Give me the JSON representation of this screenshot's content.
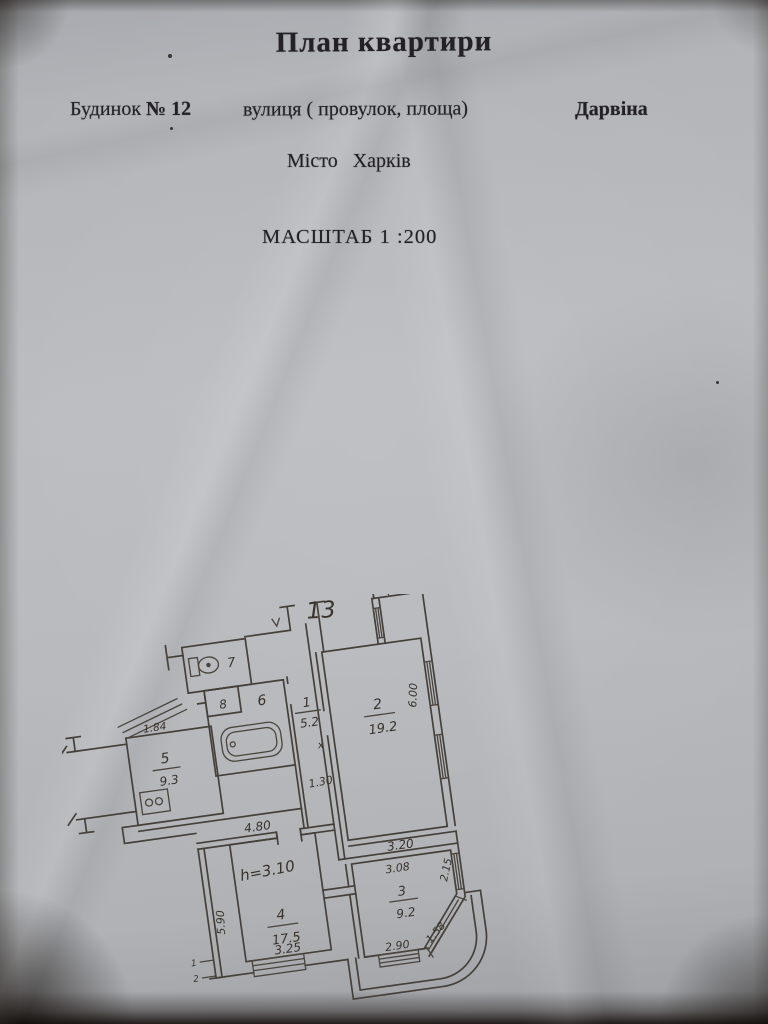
{
  "document": {
    "title": "План квартири",
    "building_label": "Будинок",
    "building_number": "№ 12",
    "street_label": "вулиця ( провулок, площа)",
    "street_name": "Дарвіна",
    "city": "Місто Харків",
    "scale": "МАСШТАБ 1 :200"
  },
  "plan": {
    "apartment_number": "13",
    "height_note": "h=3.10",
    "rooms": {
      "room1": {
        "num": "1",
        "area": "5.2"
      },
      "room2": {
        "num": "2",
        "area": "19.2"
      },
      "room3": {
        "num": "3",
        "area": "9.2"
      },
      "room4": {
        "num": "4",
        "area": "17.5"
      },
      "room5": {
        "num": "5",
        "area": "9.3"
      },
      "room6": {
        "num": "6"
      },
      "room7": {
        "num": "7"
      },
      "room8": {
        "num": "8"
      }
    },
    "dimensions": {
      "kitchen_top": "1.84",
      "kitchen_bottom": "4.80",
      "hall_width": "1.30",
      "room2_side": "6.00",
      "room2_bottom": "3.20",
      "room4_side": "5.90",
      "room4_bottom": "3.25",
      "room3_top": "3.08",
      "room3_side": "2.15",
      "room3_diagonal": "1.58",
      "room3_bottom": "2.90"
    },
    "marks": {
      "door_x": "x",
      "section_1": "1",
      "section_2": "2"
    }
  }
}
